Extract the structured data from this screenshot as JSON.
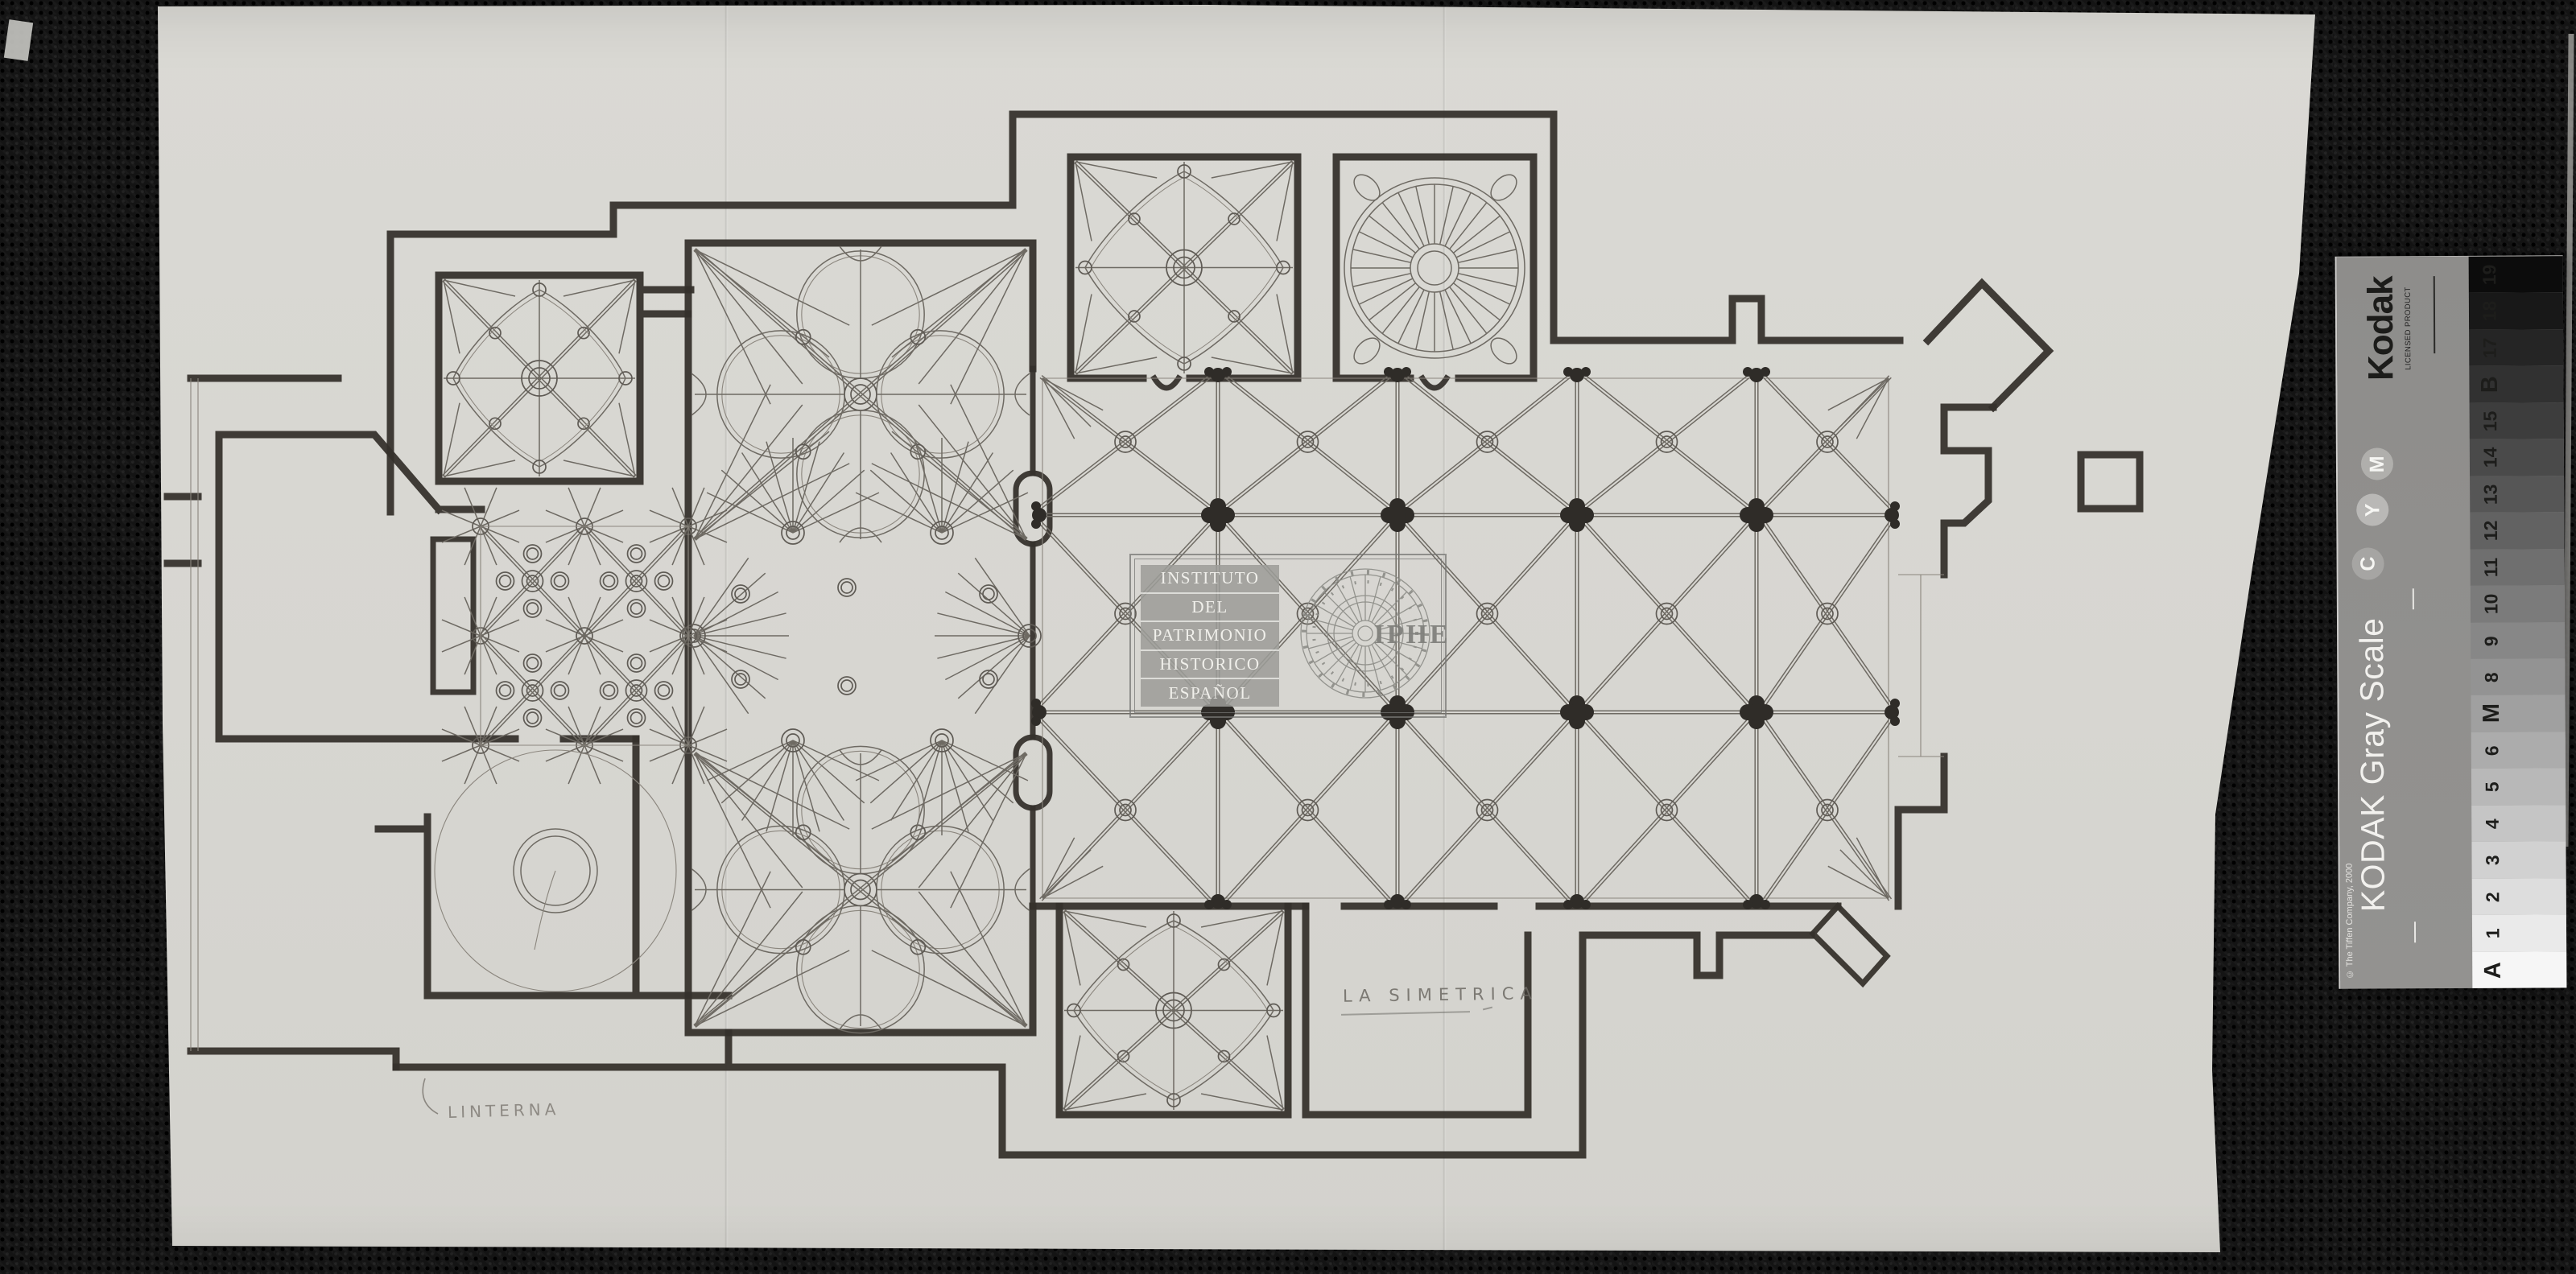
{
  "watermark": {
    "lines": [
      "INSTITUTO",
      "DEL",
      "PATRIMONIO",
      "HISTORICO",
      "ESPAÑOL"
    ],
    "acronym": "IPHE"
  },
  "annotations": {
    "la_simetrica": "LA SIMETRICA",
    "linterna": "LINTERNA"
  },
  "kodak": {
    "brand": "Kodak",
    "licensed": "LICENSED PRODUCT",
    "title": "KODAK Gray Scale",
    "copyright": "© The Tiffen Company, 2000",
    "ink_circles": [
      "M",
      "Y",
      "C"
    ],
    "scale_labels": [
      "A",
      "1",
      "2",
      "3",
      "4",
      "5",
      "6",
      "M",
      "8",
      "9",
      "10",
      "11",
      "12",
      "13",
      "14",
      "15",
      "B",
      "17",
      "18",
      "19"
    ]
  },
  "colors": {
    "paper": "#d8d7d2",
    "background": "#141414",
    "ink": "#35312c",
    "pencil": "#6d6a64",
    "watermark_gray": "#9d9d99"
  }
}
